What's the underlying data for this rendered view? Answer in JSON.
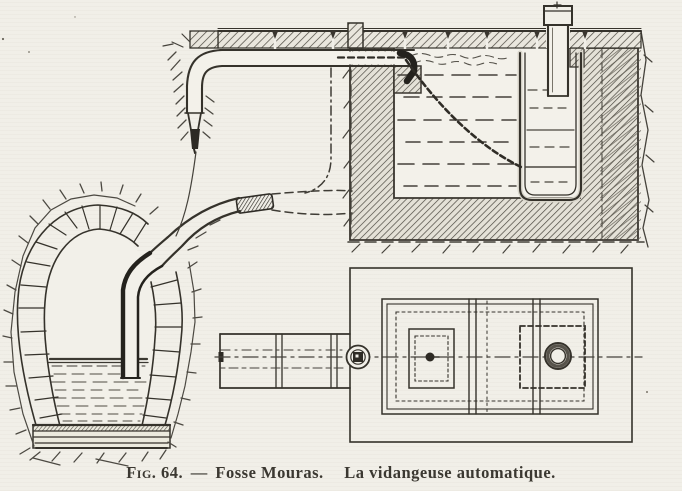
{
  "figure": {
    "fig_label": "Fig. 64.",
    "separator": "—",
    "title": "Fosse Mouras.",
    "subtitle": "La vidangeuse automatique."
  },
  "colors": {
    "paper": "#f1efe8",
    "ink": "#35322b",
    "hatch": "#55514a",
    "dark_fill": "#2d2a24"
  },
  "components": [
    "street-pavement",
    "inlet-pipe",
    "discharge-pipe",
    "discharge-nozzle",
    "tipping-bucket",
    "chain",
    "flexible-hose",
    "hose-coupling",
    "masonry-tank",
    "masonry-vault",
    "suction-pipe",
    "liquid-level",
    "foundation-base",
    "plan-view-tank",
    "plan-view-discharge-channel",
    "plan-view-pipe-openings"
  ]
}
